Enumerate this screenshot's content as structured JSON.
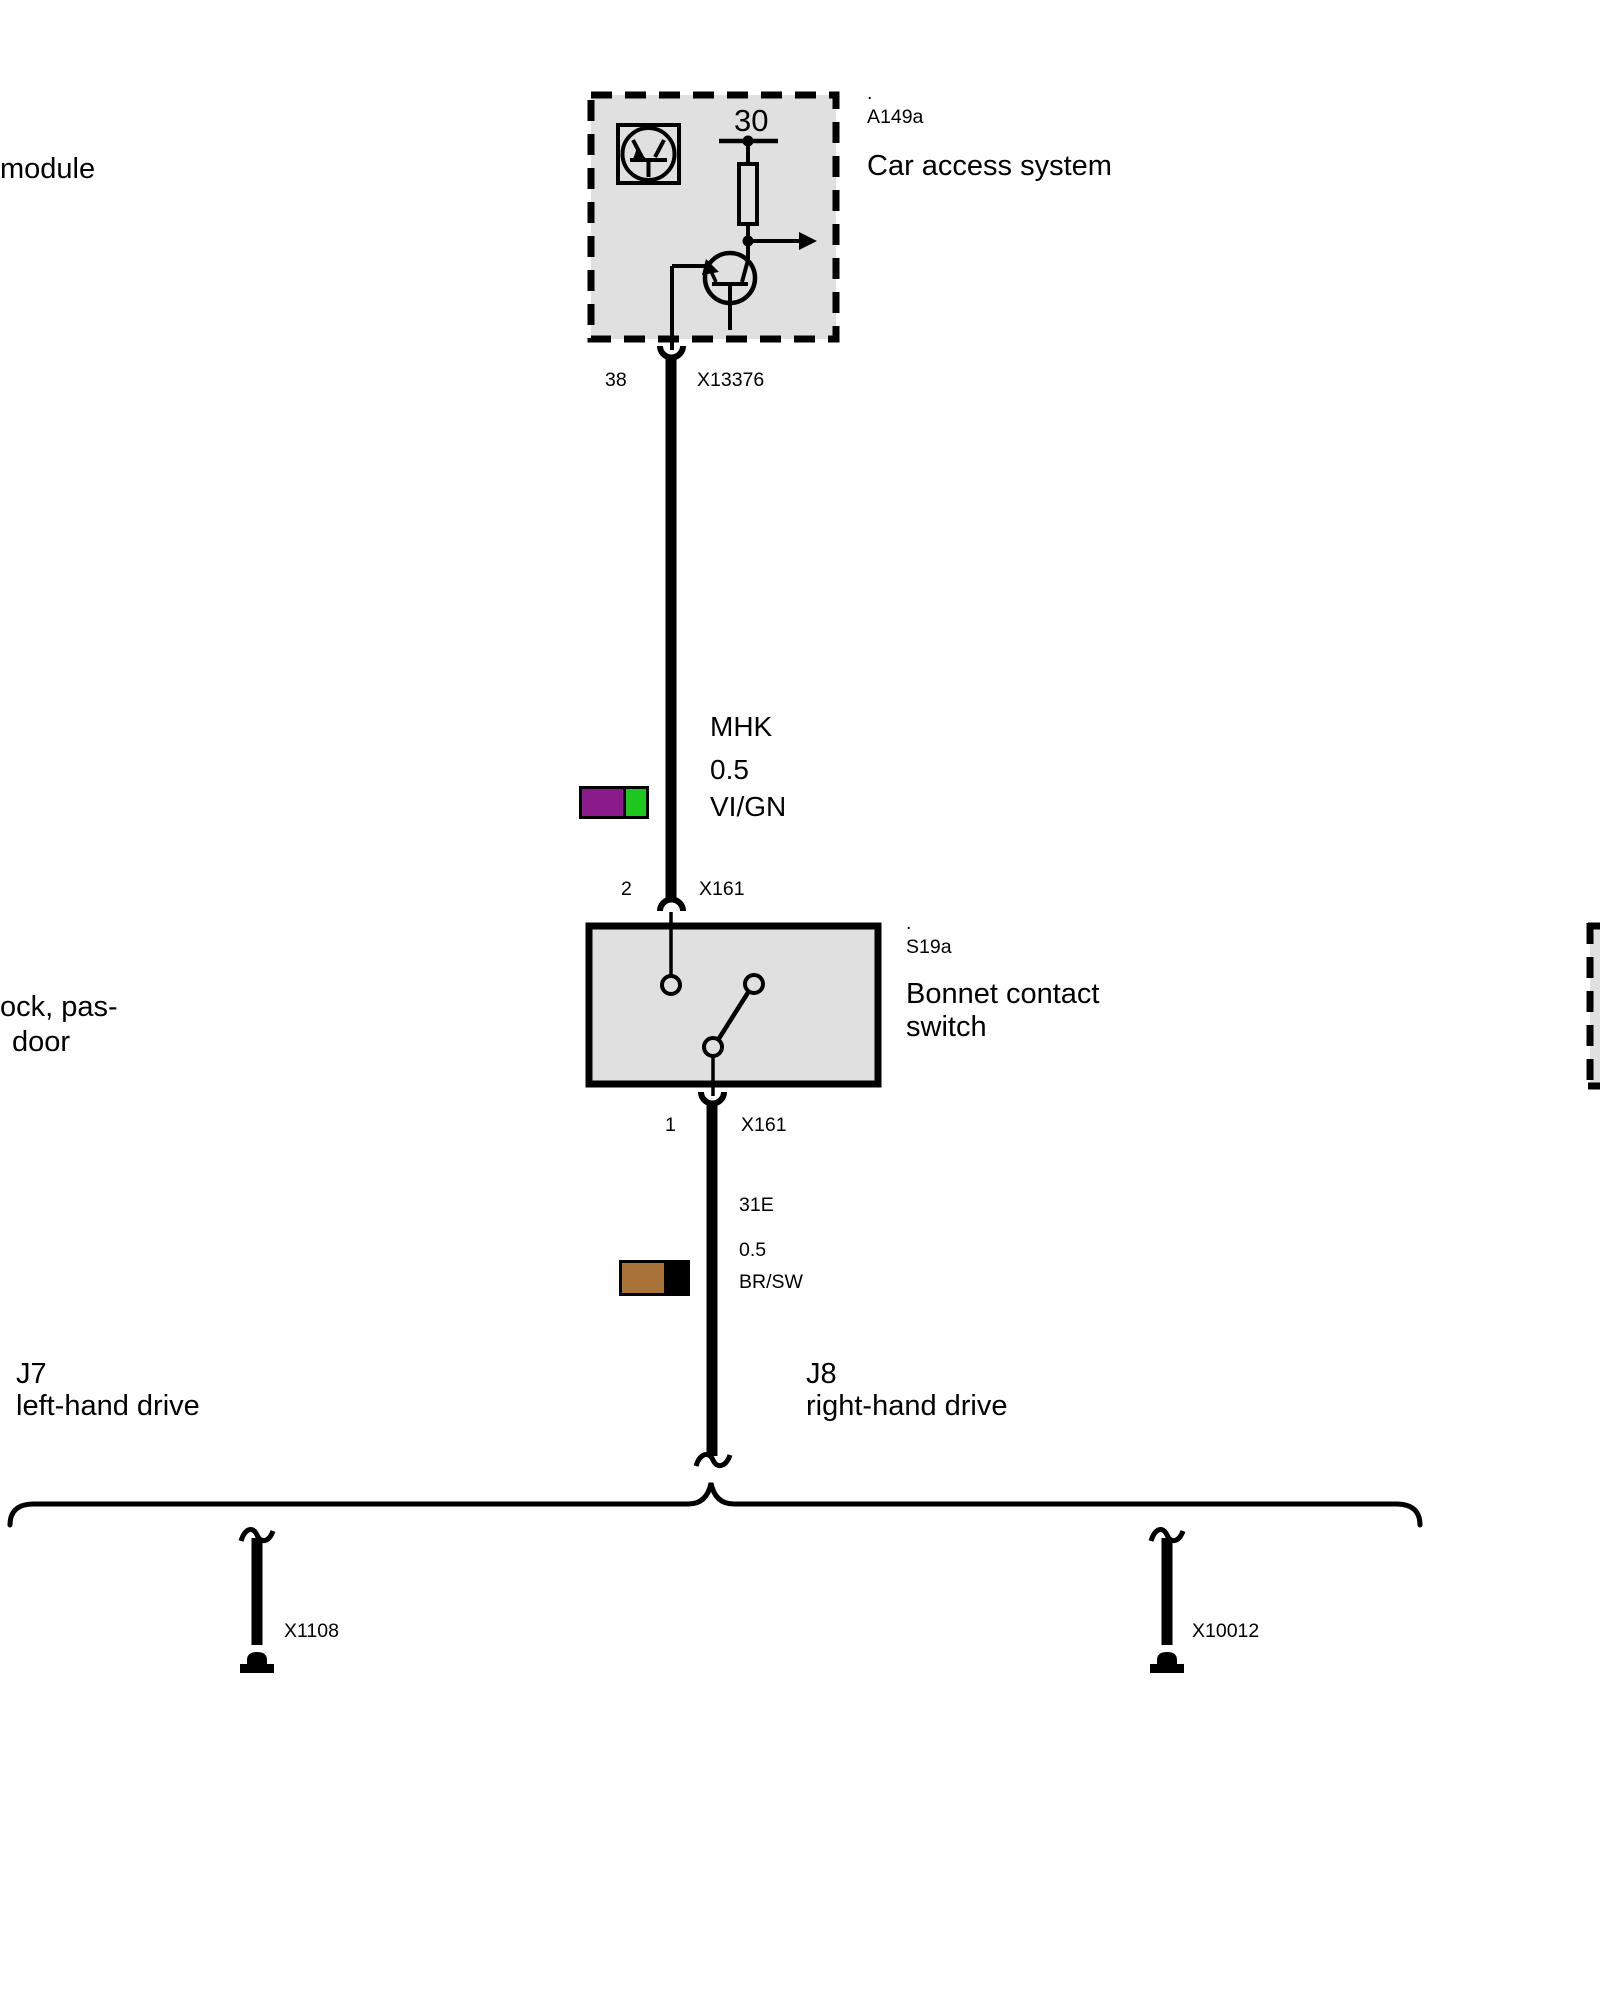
{
  "diagram": {
    "background": "#ffffff",
    "module_fill": "#e0e0e0",
    "line_color": "#000000"
  },
  "top_module": {
    "dot": ".",
    "code": "A149a",
    "name": "Car access system",
    "terminal_label": "30",
    "pin": "38",
    "connector": "X13376",
    "side_label_fragment": "module"
  },
  "upper_wire": {
    "code": "MHK",
    "cross_section": "0.5",
    "color_code": "VI/GN",
    "swatch": {
      "primary": "#8b1b8b",
      "secondary": "#1ec81e"
    }
  },
  "switch_module": {
    "dot": ".",
    "code": "S19a",
    "name": "Bonnet contact switch",
    "pin_top": "2",
    "connector_top": "X161",
    "pin_bottom": "1",
    "connector_bottom": "X161",
    "side_label_fragment_line1": "ock, pas-",
    "side_label_fragment_line2": "door"
  },
  "lower_wire": {
    "code": "31E",
    "cross_section": "0.5",
    "color_code": "BR/SW",
    "swatch": {
      "primary": "#a97239",
      "secondary": "#000000"
    }
  },
  "variants": {
    "left": {
      "code": "J7",
      "label": "left-hand drive"
    },
    "right": {
      "code": "J8",
      "label": "right-hand drive"
    }
  },
  "branch_connectors": {
    "left": {
      "label": "X1108"
    },
    "right": {
      "label": "X10012"
    }
  }
}
